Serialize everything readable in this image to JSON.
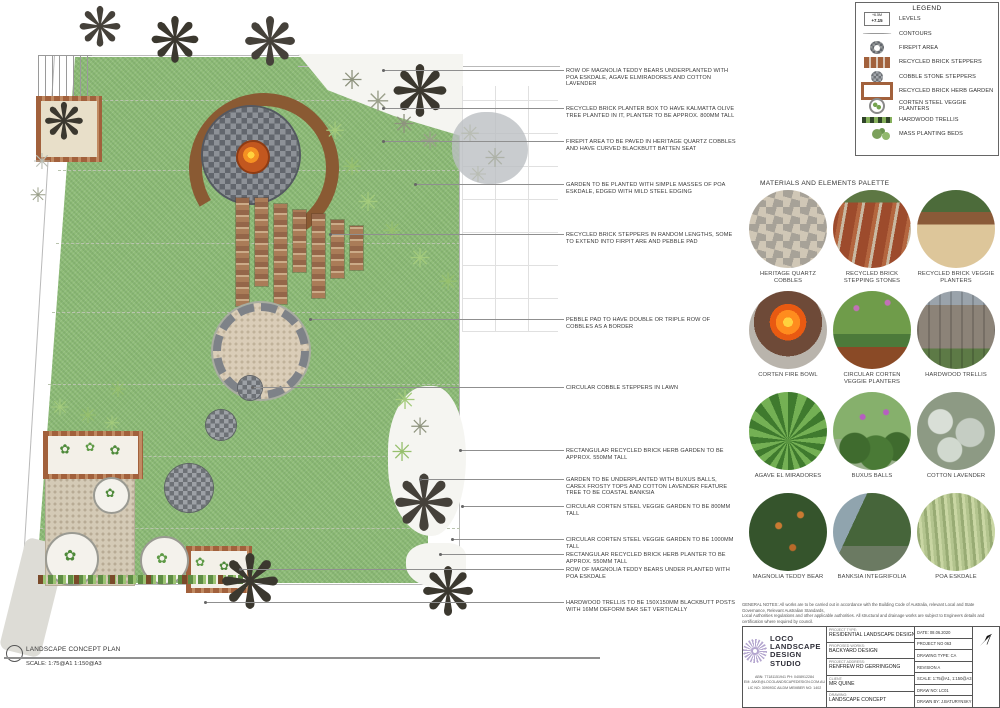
{
  "plan": {
    "glyphs": {
      "grass": "✳",
      "shrub": "✳",
      "tree": "❋",
      "herb": "✿"
    }
  },
  "annotations": [
    "ROW OF MAGNOLIA TEDDY BEARS UNDERPLANTED WITH POA ESKDALE, AGAVE ELMIRADORES AND COTTON LAVENDER",
    "RECYCLED BRICK PLANTER BOX TO HAVE KALMATTA OLIVE TREE PLANTED IN IT, PLANTER TO BE APPROX. 800MM TALL",
    "FIREPIT AREA TO BE PAVED IN HERITAGE QUARTZ COBBLES AND HAVE CURVED BLACKBUTT BATTEN SEAT",
    "GARDEN TO BE PLANTED WITH SIMPLE MASSES OF POA ESKDALE, EDGED WITH MILD STEEL EDGING",
    "RECYCLED BRICK STEPPERS IN RANDOM LENGTHS, SOME TO EXTEND INTO FIRPIT ARE AND PEBBLE PAD",
    "PEBBLE PAD TO HAVE DOUBLE OR TRIPLE ROW OF COBBLES AS A BORDER",
    "CIRCULAR COBBLE STEPPERS IN LAWN",
    "RECTANGULAR RECYCLED BRICK HERB GARDEN TO BE APPROX. 550MM TALL",
    "GARDEN TO BE UNDERPLANTED WITH BUXUS BALLS, CAREX FROSTY TOPS AND COTTON LAVENDER FEATURE TREE TO BE COASTAL BANKSIA",
    "CIRCULAR CORTEN STEEL VEGGIE GARDEN TO BE 800MM TALL",
    "CIRCULAR CORTEN STEEL VEGGIE GARDEN TO BE 1000MM TALL",
    "RECTANGULAR RECYCLED BRICK HERB PLANTER TO BE APPROX. 550MM TALL",
    "ROW OF MAGNOLIA TEDDY BEARS UNDER PLANTED WITH POA ESKDALE",
    "HARDWOOD TRELLIS TO BE 150X150MM BLACKBUTT POSTS WITH 16MM DEFORM BAR SET VERTICALLY"
  ],
  "legend": {
    "title": "LEGEND",
    "levels_value_top": "+6.5M",
    "levels_value": "+7.15",
    "items": [
      "LEVELS",
      "CONTOURS",
      "FIREPIT AREA",
      "RECYCLED BRICK STEPPERS",
      "COBBLE STONE STEPPERS",
      "RECYCLED BRICK HERB GARDEN",
      "CORTEN STEEL VEGGIE PLANTERS",
      "HARDWOOD TRELLIS",
      "MASS PLANTING BEDS"
    ]
  },
  "palette": {
    "title": "MATERIALS AND ELEMENTS PALETTE",
    "items": [
      "HERITAGE QUARTZ COBBLES",
      "RECYCLED BRICK STEPPING STONES",
      "RECYCLED BRICK VEGGIE PLANTERS",
      "CORTEN FIRE BOWL",
      "CIRCULAR CORTEN VEGGIE PLANTERS",
      "HARDWOOD TRELLIS",
      "AGAVE EL MIRADORES",
      "BUXUS BALLS",
      "COTTON LAVENDER",
      "MAGNOLIA TEDDY BEAR",
      "BANKSIA INTEGRIFOLIA",
      "POA ESKDALE"
    ]
  },
  "titleblock": {
    "notes_line1": "GENERAL NOTES: All works are to be carried out in accordance with the Building Code of Australia, relevant Local and State Governance, Relevant Australian Standards,",
    "notes_line2": "Local Authorities regulations and other applicable authorities. All structural and drainage works are subject to Engineers details and certification where required by council.",
    "company": {
      "name_line1": "LOCO LANDSCAPE",
      "name_line2": "DESIGN STUDIO",
      "abn": "ABN: 77181151941    PH: 0408912284",
      "email": "EM: JAKE@LOCOLANDSCAPEDESIGN.COM.AU",
      "lic": "LIC NO: 309093C    AILDM MEMBER NO: 1402"
    },
    "fields": [
      {
        "label": "PROJECT TYPE:",
        "value": "RESIDENTIAL LANDSCAPE DESIGN"
      },
      {
        "label": "PROPOSED WORKS:",
        "value": "BACKYARD DESIGN"
      },
      {
        "label": "PROJECT ADDRESS:",
        "value": "RENFREW RD GERRINGONG"
      },
      {
        "label": "CLIENT:",
        "value": "MR QUINE"
      },
      {
        "label": "DRAWING:",
        "value": "LANDSCAPE CONCEPT"
      }
    ],
    "meta": [
      "DATE: 08.06.2020",
      "PROJECT NO 063",
      "DRAWING TYPE: CA",
      "REVISION A",
      "SCALE: 1:75@A1, 1:150@A3",
      "DRAW NO: LC01",
      "DRAWN BY: J.BATURYNSKY"
    ]
  },
  "footer": {
    "title": "LANDSCAPE CONCEPT PLAN",
    "scale": "SCALE: 1:75@A1 1:150@A3"
  },
  "colors": {
    "lawn": "#8fbc78",
    "cobble": "#62666d",
    "brick": "#a2613c",
    "timber": "#8a5a33",
    "fire": "#e8731f",
    "corten": "#8a4a26",
    "logo": "#b4a6cf"
  }
}
